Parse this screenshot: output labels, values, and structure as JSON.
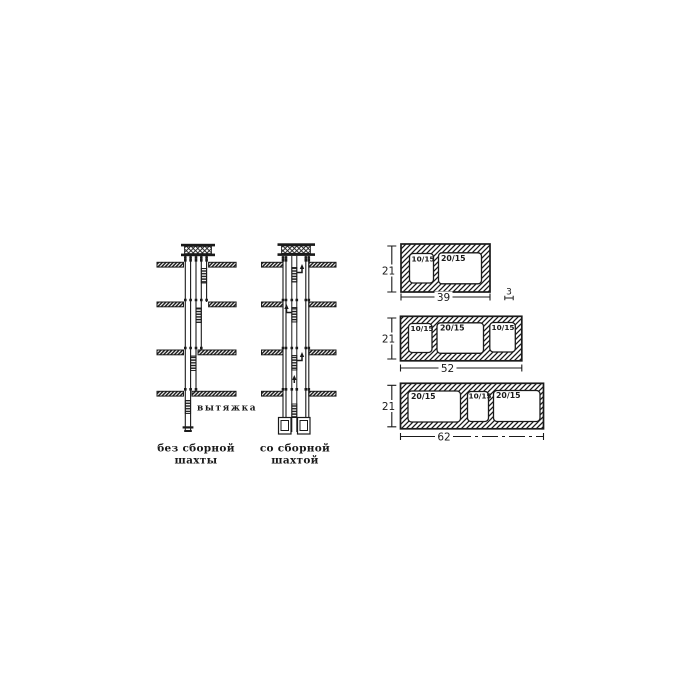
{
  "figure": {
    "left_diagram": {
      "exhaust_label": "вытяжка",
      "caption": [
        "без сборной",
        "шахты"
      ]
    },
    "right_diagram": {
      "caption": [
        "со сборной",
        "шахтой"
      ]
    },
    "blocks": [
      {
        "height": "21",
        "width": "39",
        "wall_thickness": "3",
        "openings": [
          "10/15",
          "20/15"
        ]
      },
      {
        "height": "21",
        "width": "52",
        "openings": [
          "10/15",
          "20/15",
          "10/15"
        ]
      },
      {
        "height": "21",
        "width": "62",
        "openings": [
          "20/15",
          "10/15",
          "20/15"
        ]
      }
    ],
    "colors": {
      "ink": "#1a1a1a",
      "paper": "#ffffff"
    }
  }
}
